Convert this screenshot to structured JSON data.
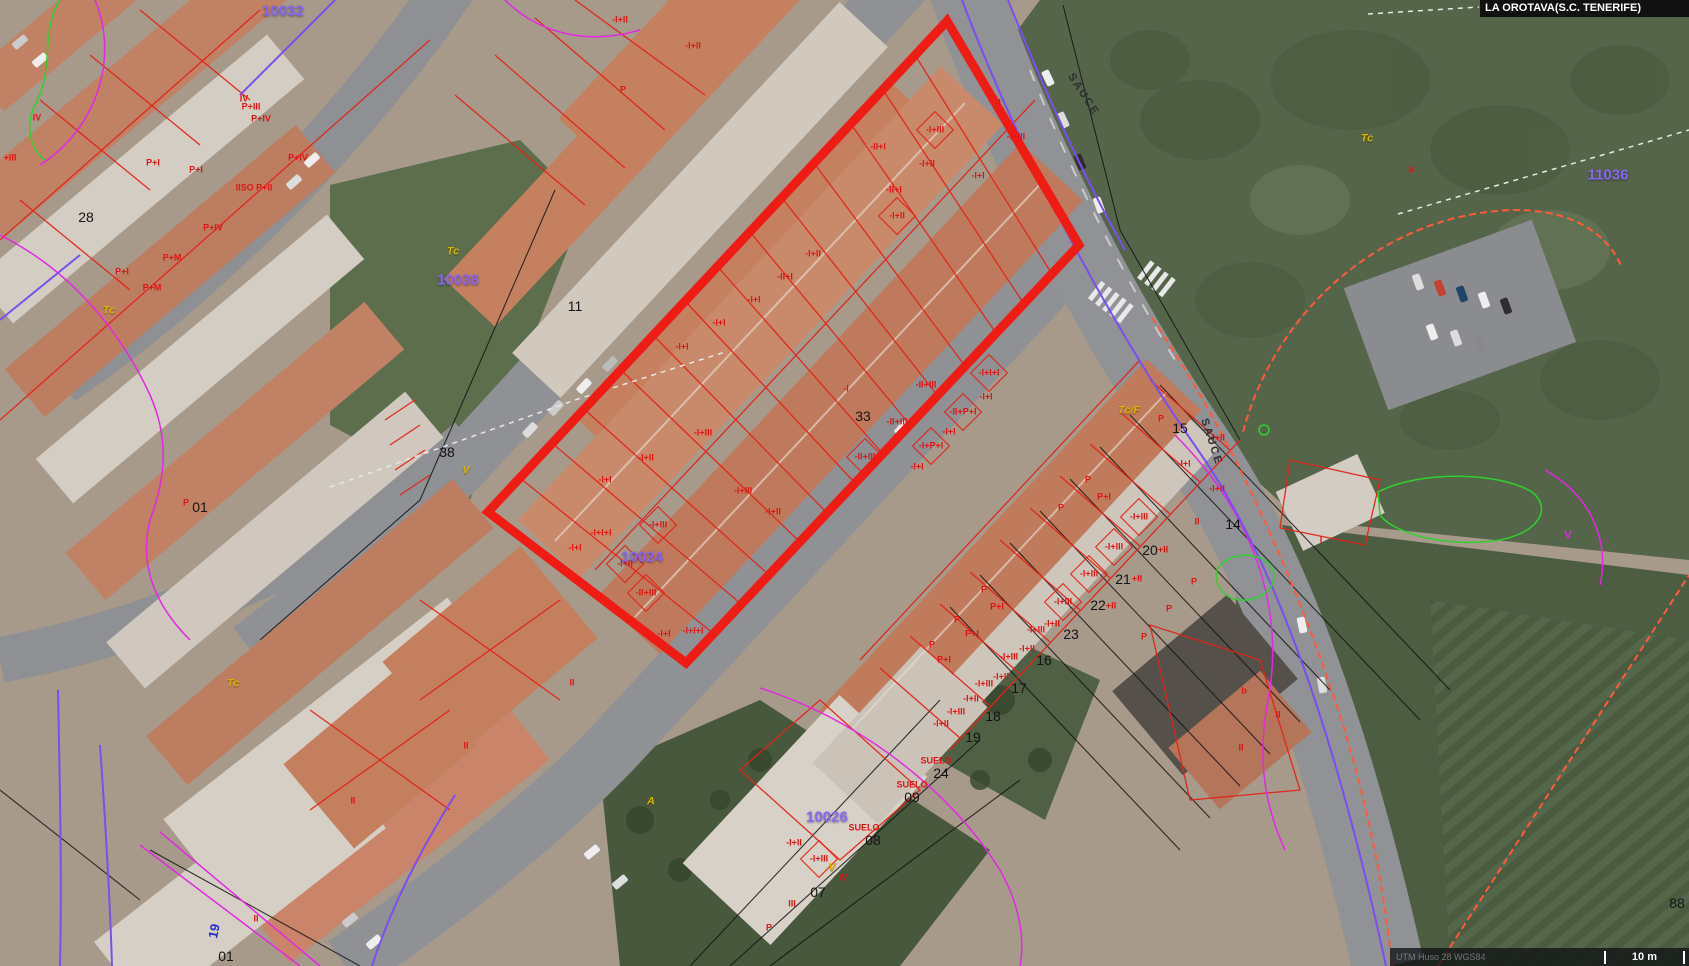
{
  "header": {
    "municipality": "LA OROTAVA(S.C. TENERIFE)"
  },
  "footer": {
    "crs": "UTM Huso 28 WGS84",
    "scale_label": "10 m"
  },
  "colors": {
    "selection_red": "#ee1c14",
    "parcel_id_purple": "#8a66f2",
    "height_code_red": "#e01414",
    "land_use_yellow": "#d8b400",
    "boundary_magenta": "#e328e3",
    "boundary_purple": "#7a4ef0",
    "vegetation_green": "#2fd12f",
    "parcel_line_black": "#141414",
    "dashed_orange": "#ff5a3a"
  },
  "map": {
    "street_name": "SAUCE",
    "label_groups": [
      {
        "name": "parcel-id",
        "cls": "lbl-purple",
        "items": [
          [
            "10032",
            283,
            11
          ],
          [
            "10038",
            458,
            280
          ],
          [
            "10024",
            642,
            557
          ],
          [
            "10026",
            827,
            817
          ],
          [
            "11036",
            1608,
            175
          ]
        ]
      },
      {
        "name": "plot-number",
        "cls": "lbl-num",
        "items": [
          [
            "28",
            86,
            217
          ],
          [
            "11",
            575,
            306
          ],
          [
            "38",
            447,
            452
          ],
          [
            "33",
            863,
            416
          ],
          [
            "15",
            1180,
            428
          ],
          [
            "14",
            1233,
            524
          ],
          [
            "20",
            1150,
            550
          ],
          [
            "21",
            1123,
            579
          ],
          [
            "22",
            1098,
            605
          ],
          [
            "23",
            1071,
            634
          ],
          [
            "16",
            1044,
            660
          ],
          [
            "17",
            1019,
            688
          ],
          [
            "18",
            993,
            716
          ],
          [
            "19",
            973,
            737
          ],
          [
            "24",
            941,
            773
          ],
          [
            "09",
            912,
            797
          ],
          [
            "08",
            873,
            840
          ],
          [
            "07",
            818,
            892
          ],
          [
            "01",
            226,
            956
          ],
          [
            "01",
            200,
            507
          ],
          [
            "88",
            1677,
            903
          ]
        ]
      },
      {
        "name": "height-code",
        "cls": "lbl-code",
        "items": [
          [
            "-I+II",
            620,
            20
          ],
          [
            "-I+II",
            693,
            46
          ],
          [
            "P",
            623,
            90
          ],
          [
            "-I",
            998,
            103
          ],
          [
            "-I+III",
            1016,
            137
          ],
          [
            "-I+III",
            935,
            130
          ],
          [
            "-II+I",
            878,
            147
          ],
          [
            "-I+II",
            927,
            164
          ],
          [
            "-I+I",
            978,
            176
          ],
          [
            "-II+I",
            894,
            190
          ],
          [
            "-I+II",
            897,
            216
          ],
          [
            "-I+II",
            813,
            254
          ],
          [
            "-II+I",
            785,
            277
          ],
          [
            "-I+I",
            754,
            300
          ],
          [
            "-I+I",
            719,
            323
          ],
          [
            "-I+I",
            682,
            347
          ],
          [
            "-I",
            846,
            389
          ],
          [
            "-I+I+I",
            989,
            373
          ],
          [
            "-II+III",
            926,
            385
          ],
          [
            "-I+I",
            986,
            397
          ],
          [
            "-II+P+I",
            963,
            412
          ],
          [
            "-II+III",
            897,
            422
          ],
          [
            "-I+I",
            949,
            432
          ],
          [
            "-I+P+I",
            931,
            446
          ],
          [
            "-II+III",
            865,
            457
          ],
          [
            "-I+I",
            917,
            467
          ],
          [
            "-I+III",
            703,
            433
          ],
          [
            "-I+II",
            646,
            458
          ],
          [
            "-I+I",
            605,
            480
          ],
          [
            "-I+III",
            743,
            491
          ],
          [
            "-I+II",
            773,
            512
          ],
          [
            "-I+I+I",
            601,
            533
          ],
          [
            "-I+III",
            658,
            525
          ],
          [
            "-I+I",
            575,
            548
          ],
          [
            "-I+II",
            625,
            564
          ],
          [
            "-II+III",
            646,
            593
          ],
          [
            "-I+I+I",
            693,
            631
          ],
          [
            "-I+I",
            664,
            634
          ],
          [
            "P",
            1161,
            419
          ],
          [
            "-I+II",
            1217,
            438
          ],
          [
            "-I+I",
            1184,
            464
          ],
          [
            "-I+II",
            1217,
            489
          ],
          [
            "P",
            1088,
            480
          ],
          [
            "P+I",
            1104,
            497
          ],
          [
            "P",
            1061,
            508
          ],
          [
            "-I+III",
            1139,
            517
          ],
          [
            "II",
            1197,
            522
          ],
          [
            "-I+III",
            1114,
            547
          ],
          [
            "+II",
            1163,
            550
          ],
          [
            "-I+III",
            1089,
            574
          ],
          [
            "+II",
            1137,
            579
          ],
          [
            "-I+III",
            1063,
            602
          ],
          [
            "+II",
            1111,
            606
          ],
          [
            "-I+II",
            1052,
            624
          ],
          [
            "-I+III",
            1036,
            630
          ],
          [
            "-I+II",
            1027,
            649
          ],
          [
            "-I+III",
            1009,
            657
          ],
          [
            "-I+II",
            1001,
            677
          ],
          [
            "-I+III",
            984,
            684
          ],
          [
            "-I+II",
            971,
            699
          ],
          [
            "-I+III",
            956,
            712
          ],
          [
            "-I+II",
            941,
            724
          ],
          [
            "P",
            1194,
            582
          ],
          [
            "P",
            1169,
            609
          ],
          [
            "P",
            1144,
            637
          ],
          [
            "P",
            984,
            590
          ],
          [
            "P+I",
            997,
            607
          ],
          [
            "P",
            957,
            620
          ],
          [
            "P+I",
            972,
            634
          ],
          [
            "P",
            932,
            645
          ],
          [
            "P+I",
            944,
            660
          ],
          [
            "SUELO",
            936,
            761
          ],
          [
            "SUELO",
            912,
            785
          ],
          [
            "SUELO",
            864,
            828
          ],
          [
            "-I+II",
            794,
            843
          ],
          [
            "-I+III",
            819,
            859
          ],
          [
            "IV",
            843,
            878
          ],
          [
            "III",
            792,
            904
          ],
          [
            "P",
            769,
            928
          ],
          [
            "IV",
            37,
            118
          ],
          [
            "+III",
            10,
            158
          ],
          [
            "P+I",
            153,
            163
          ],
          [
            "P+I",
            196,
            170
          ],
          [
            "IV",
            244,
            99
          ],
          [
            "P+III",
            251,
            107
          ],
          [
            "P+IV",
            261,
            119
          ],
          [
            "P+IV",
            298,
            158
          ],
          [
            "IISO P+II",
            254,
            188
          ],
          [
            "P+IV",
            213,
            228
          ],
          [
            "P+M",
            172,
            258
          ],
          [
            "P+M",
            152,
            288
          ],
          [
            "P+I",
            122,
            272
          ],
          [
            "P",
            186,
            503
          ],
          [
            "II",
            572,
            683
          ],
          [
            "II",
            466,
            746
          ],
          [
            "II",
            353,
            801
          ],
          [
            "II",
            256,
            919
          ],
          [
            "I",
            1321,
            540
          ],
          [
            "b",
            1244,
            691
          ],
          [
            "II",
            1278,
            715
          ],
          [
            "II",
            1241,
            748
          ]
        ]
      },
      {
        "name": "land-use",
        "cls": "lbl-yellow",
        "items": [
          [
            "Tc",
            453,
            252
          ],
          [
            "Tc",
            1367,
            139
          ],
          [
            "Tc",
            109,
            311
          ],
          [
            "Tc",
            233,
            684
          ],
          [
            "Tc/F",
            1129,
            411
          ],
          [
            "V",
            466,
            471
          ],
          [
            "V",
            832,
            868
          ],
          [
            "A",
            651,
            802
          ]
        ]
      },
      {
        "name": "street-name",
        "cls": "lbl-street",
        "items": [
          [
            "SAUCE",
            1083,
            95,
            57
          ],
          [
            "SAUCE",
            1211,
            442,
            72
          ]
        ]
      },
      {
        "name": "boundary-letter",
        "cls": "lbl-magenta",
        "items": [
          [
            "V",
            1568,
            536
          ]
        ]
      },
      {
        "name": "road-number",
        "cls": "lbl-blue",
        "items": [
          [
            "19",
            214,
            931,
            -78
          ]
        ]
      },
      {
        "name": "curve-point",
        "cls": "lbl-reda",
        "items": [
          [
            "a",
            1411,
            170
          ]
        ]
      }
    ]
  }
}
